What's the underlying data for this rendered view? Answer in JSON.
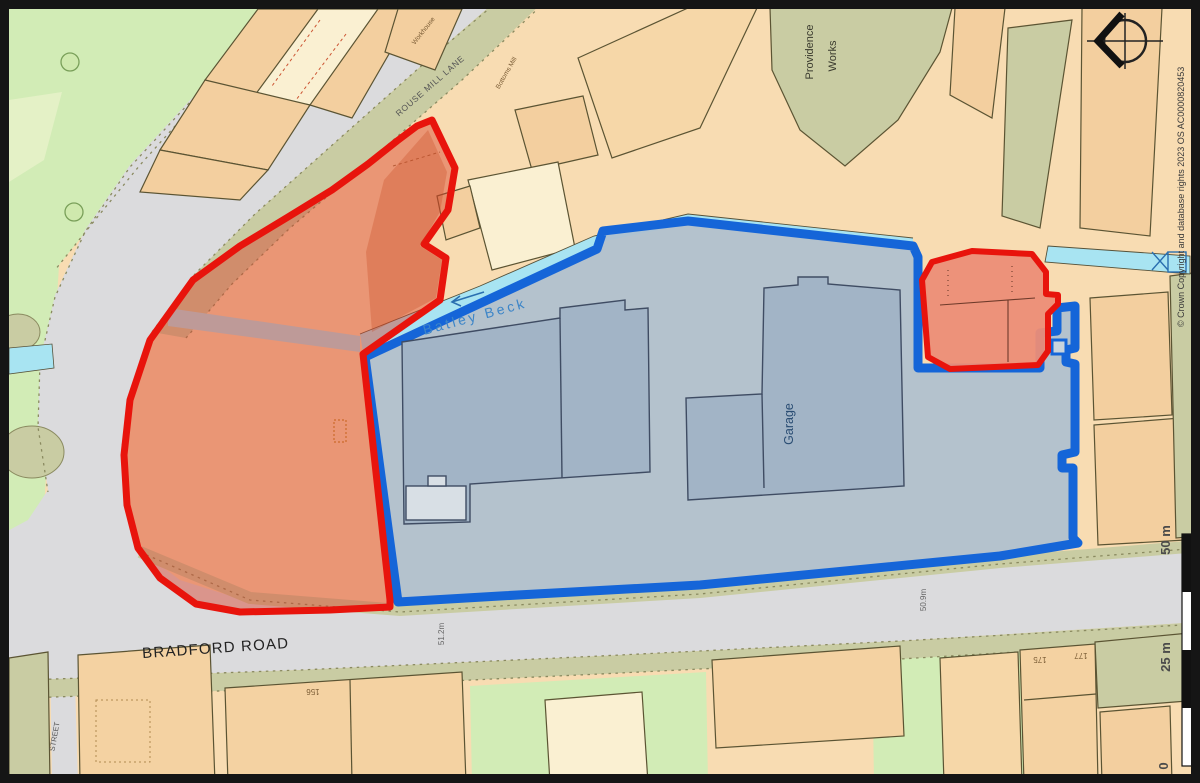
{
  "colors": {
    "red_boundary": "#E8140C",
    "blue_boundary": "#1565D8",
    "water": "#A8E4F2",
    "road": "#DBDBDD",
    "green_space": "#D2ECB6",
    "olive": "#C9CCA3",
    "land": "#F8DCB2"
  },
  "map": {
    "roads": {
      "bradford_road": "BRADFORD ROAD",
      "rouse_mill_lane": "ROUSE MILL LANE",
      "street": "STREET"
    },
    "places": {
      "providence_works_line1": "Providence",
      "providence_works_line2": "Works",
      "garage": "Garage",
      "batley_beck": "Batley Beck",
      "workhouse": "Workhouse",
      "bottoms_mill": "Bottoms Mill"
    },
    "spot_heights": {
      "west": "51.2m",
      "east": "50.9m"
    },
    "house_numbers": {
      "n156": "156",
      "n175": "175",
      "n177": "177"
    },
    "scale_bar": {
      "top": "50 m",
      "mid": "25 m",
      "zero": "0"
    },
    "copyright": "© Crown Copyright and database rights 2023 OS AC0000820453"
  }
}
